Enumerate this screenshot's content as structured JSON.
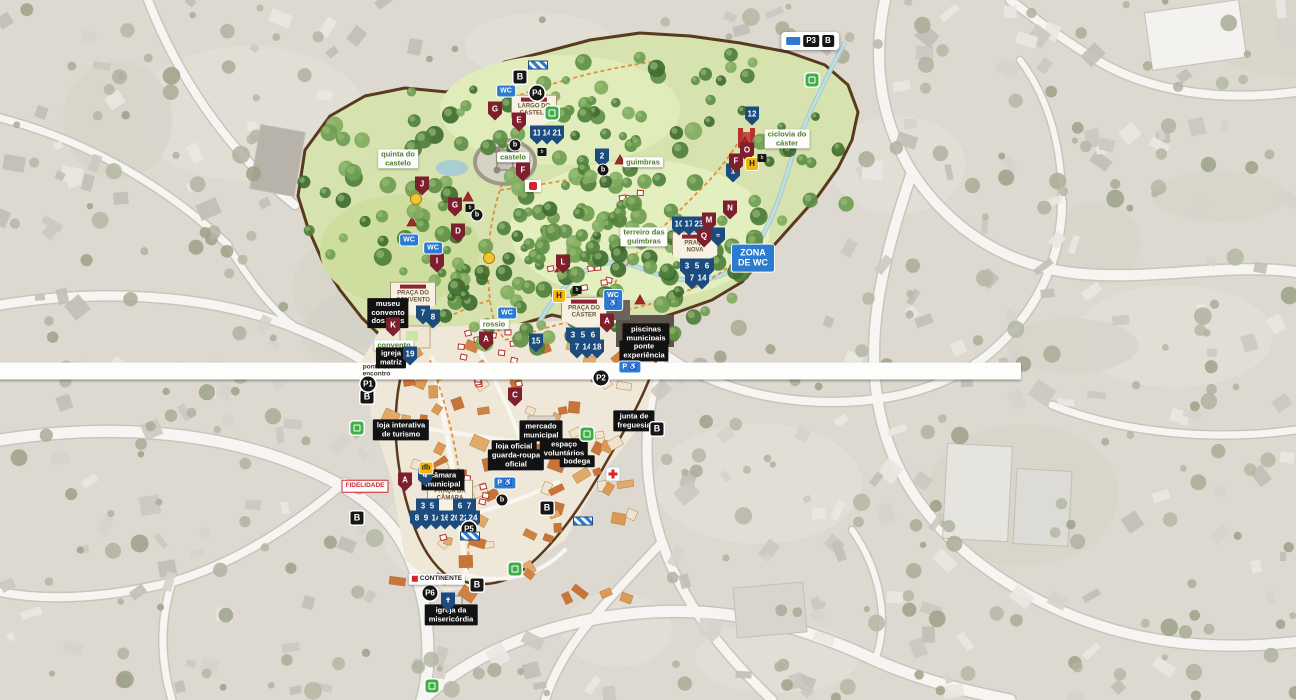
{
  "map": {
    "subject": "illustrated festival town map",
    "colors": {
      "attraction_shield_blue": "#1c4b7e",
      "area_shield_maroon": "#7d1f2d",
      "services_blue": "#2b7bd1",
      "festival_green": "#d7e3ae",
      "route_orange": "#e08a35",
      "fence_brown": "#5a3a1e",
      "entrance_green": "#3fae49"
    }
  },
  "markers": [
    {
      "name": "zone-crest-largo-do-castelo",
      "type": "crest",
      "x": 534,
      "y": 112,
      "lines": [
        "LARGO DO",
        "CASTELO"
      ]
    },
    {
      "name": "zone-crest-praca-do-convento",
      "type": "crest",
      "x": 413,
      "y": 299,
      "lines": [
        "PRAÇA DO",
        "CONVENTO"
      ]
    },
    {
      "name": "zone-crest-praca-nova",
      "type": "crest",
      "x": 695,
      "y": 249,
      "lines": [
        "PRAÇA",
        "NOVA"
      ]
    },
    {
      "name": "zone-crest-praca-do-caster",
      "type": "crest",
      "x": 584,
      "y": 314,
      "lines": [
        "PRAÇA DO",
        "CÁSTER"
      ]
    },
    {
      "name": "zone-crest-praca-da-camara",
      "type": "crest",
      "x": 450,
      "y": 497,
      "lines": [
        "PRAÇA DA",
        "CÂMARA"
      ]
    },
    {
      "name": "quinta-do-castelo-label",
      "type": "lblg",
      "x": 398,
      "y": 159,
      "lines": [
        "quinta do",
        "castelo"
      ]
    },
    {
      "name": "castelo-label",
      "type": "lblg",
      "x": 513,
      "y": 157,
      "text": "castelo"
    },
    {
      "name": "guimbras-label",
      "type": "lblg",
      "x": 643,
      "y": 162,
      "text": "guimbras"
    },
    {
      "name": "terreiro-das-guimbras-label",
      "type": "lblg",
      "x": 644,
      "y": 237,
      "lines": [
        "terreiro das",
        "guimbras"
      ]
    },
    {
      "name": "ciclovia-do-caster-label",
      "type": "lblg",
      "x": 787,
      "y": 139,
      "lines": [
        "ciclovia do",
        "cáster"
      ]
    },
    {
      "name": "rossio-label",
      "type": "lblg",
      "x": 494,
      "y": 324,
      "text": "rossio"
    },
    {
      "name": "convento-label",
      "type": "lblg",
      "x": 394,
      "y": 345,
      "text": "convento"
    },
    {
      "name": "ponto-de-encontro-label",
      "type": "lblw",
      "x": 373,
      "y": 371,
      "lines": [
        "ponto de",
        "encontro"
      ]
    },
    {
      "name": "museu-convento-dos-loios-label",
      "type": "lblb",
      "x": 388,
      "y": 313,
      "lines": [
        "museu",
        "convento",
        "dos lóios"
      ]
    },
    {
      "name": "igreja-matriz-label",
      "type": "lblb",
      "x": 391,
      "y": 358,
      "lines": [
        "igreja",
        "matriz"
      ]
    },
    {
      "name": "loja-interativa-de-turismo-label",
      "type": "lblb",
      "x": 401,
      "y": 430,
      "lines": [
        "loja interativa",
        "de turismo"
      ]
    },
    {
      "name": "camara-municipal-label",
      "type": "lblb",
      "x": 443,
      "y": 480,
      "lines": [
        "câmara",
        "municipal"
      ]
    },
    {
      "name": "mercado-municipal-label",
      "type": "lblb",
      "x": 541,
      "y": 431,
      "lines": [
        "mercado",
        "municipal"
      ]
    },
    {
      "name": "loja-oficial-label",
      "type": "lblb",
      "x": 514,
      "y": 446,
      "text": "loja oficial"
    },
    {
      "name": "guarda-roupa-oficial-label",
      "type": "lblb",
      "x": 516,
      "y": 460,
      "lines": [
        "guarda-roupa",
        "oficial"
      ]
    },
    {
      "name": "espaco-voluntarios-label",
      "type": "lblb",
      "x": 564,
      "y": 449,
      "lines": [
        "espaço",
        "voluntários"
      ]
    },
    {
      "name": "bodega-label",
      "type": "lblb",
      "x": 577,
      "y": 461,
      "text": "bodega"
    },
    {
      "name": "junta-de-freguesia-label",
      "type": "lblb",
      "x": 634,
      "y": 421,
      "lines": [
        "junta de",
        "freguesia"
      ]
    },
    {
      "name": "piscinas-municipais-label",
      "type": "lblb",
      "x": 646,
      "y": 334,
      "lines": [
        "piscinas",
        "municipais"
      ]
    },
    {
      "name": "ponte-experiencia-label",
      "type": "lblb",
      "x": 644,
      "y": 351,
      "lines": [
        "ponte",
        "experiência"
      ]
    },
    {
      "name": "igreja-da-misericordia-label",
      "type": "lblb",
      "x": 451,
      "y": 615,
      "lines": [
        "igreja da",
        "misericórdia"
      ]
    },
    {
      "name": "attraction-badge-11",
      "type": "sb",
      "x": 537,
      "y": 135,
      "text": "11"
    },
    {
      "name": "attraction-badge-14",
      "type": "sb",
      "x": 547,
      "y": 135,
      "text": "14"
    },
    {
      "name": "attraction-badge-21",
      "type": "sb",
      "x": 557,
      "y": 135,
      "text": "21"
    },
    {
      "name": "attraction-badge-2",
      "type": "sb",
      "x": 602,
      "y": 158,
      "text": "2"
    },
    {
      "name": "attraction-badge-12",
      "type": "sb",
      "x": 752,
      "y": 116,
      "text": "12"
    },
    {
      "name": "attraction-badge-1",
      "type": "sb",
      "x": 733,
      "y": 173,
      "text": "1"
    },
    {
      "name": "attraction-badge-10",
      "type": "sb",
      "x": 679,
      "y": 226,
      "text": "10"
    },
    {
      "name": "attraction-badge-17",
      "type": "sb",
      "x": 689,
      "y": 226,
      "text": "17"
    },
    {
      "name": "attraction-badge-23",
      "type": "sb",
      "x": 699,
      "y": 226,
      "text": "23"
    },
    {
      "name": "attraction-badge-3",
      "type": "sb",
      "x": 687,
      "y": 268,
      "text": "3"
    },
    {
      "name": "attraction-badge-5",
      "type": "sb",
      "x": 697,
      "y": 268,
      "text": "5"
    },
    {
      "name": "attraction-badge-6",
      "type": "sb",
      "x": 707,
      "y": 268,
      "text": "6"
    },
    {
      "name": "attraction-badge-7",
      "type": "sb",
      "x": 692,
      "y": 280,
      "text": "7"
    },
    {
      "name": "attraction-badge-14b",
      "type": "sb",
      "x": 702,
      "y": 280,
      "text": "14"
    },
    {
      "name": "attraction-badge-3b",
      "type": "sb",
      "x": 573,
      "y": 337,
      "text": "3"
    },
    {
      "name": "attraction-badge-5b",
      "type": "sb",
      "x": 583,
      "y": 337,
      "text": "5"
    },
    {
      "name": "attraction-badge-6b",
      "type": "sb",
      "x": 593,
      "y": 337,
      "text": "6"
    },
    {
      "name": "attraction-badge-7b",
      "type": "sb",
      "x": 577,
      "y": 349,
      "text": "7"
    },
    {
      "name": "attraction-badge-14c",
      "type": "sb",
      "x": 587,
      "y": 349,
      "text": "14"
    },
    {
      "name": "attraction-badge-18",
      "type": "sb",
      "x": 597,
      "y": 349,
      "text": "18"
    },
    {
      "name": "attraction-badge-15",
      "type": "sb",
      "x": 536,
      "y": 343,
      "text": "15"
    },
    {
      "name": "attraction-badge-7c",
      "type": "sb",
      "x": 423,
      "y": 315,
      "text": "7"
    },
    {
      "name": "attraction-badge-8",
      "type": "sb",
      "x": 433,
      "y": 319,
      "text": "8"
    },
    {
      "name": "attraction-badge-19",
      "type": "sb",
      "x": 410,
      "y": 356,
      "text": "19"
    },
    {
      "name": "attraction-badge-4",
      "type": "sb",
      "x": 425,
      "y": 477,
      "text": "4"
    },
    {
      "name": "attraction-badge-3c",
      "type": "sb",
      "x": 423,
      "y": 508,
      "text": "3"
    },
    {
      "name": "attraction-badge-5c",
      "type": "sb",
      "x": 432,
      "y": 508,
      "text": "5"
    },
    {
      "name": "attraction-badge-6c",
      "type": "sb",
      "x": 460,
      "y": 508,
      "text": "6"
    },
    {
      "name": "attraction-badge-7d",
      "type": "sb",
      "x": 469,
      "y": 508,
      "text": "7"
    },
    {
      "name": "attraction-badge-8b",
      "type": "sb",
      "x": 417,
      "y": 520,
      "text": "8"
    },
    {
      "name": "attraction-badge-9",
      "type": "sb",
      "x": 426,
      "y": 520,
      "text": "9"
    },
    {
      "name": "attraction-badge-14d",
      "type": "sb",
      "x": 436,
      "y": 520,
      "text": "14"
    },
    {
      "name": "attraction-badge-16",
      "type": "sb",
      "x": 445,
      "y": 520,
      "text": "16"
    },
    {
      "name": "attraction-badge-20",
      "type": "sb",
      "x": 455,
      "y": 520,
      "text": "20"
    },
    {
      "name": "attraction-badge-22",
      "type": "sb",
      "x": 464,
      "y": 520,
      "text": "22"
    },
    {
      "name": "attraction-badge-24",
      "type": "sb",
      "x": 473,
      "y": 520,
      "text": "24"
    },
    {
      "name": "church-badge",
      "type": "sbi",
      "x": 448,
      "y": 602,
      "text": "✝"
    },
    {
      "name": "fountain-badge",
      "type": "sbi",
      "x": 718,
      "y": 237,
      "text": "≈"
    },
    {
      "name": "area-badge-e",
      "type": "sm",
      "x": 519,
      "y": 122,
      "text": "E"
    },
    {
      "name": "area-badge-f",
      "type": "sm",
      "x": 523,
      "y": 172,
      "text": "F"
    },
    {
      "name": "area-badge-g",
      "type": "sm",
      "x": 495,
      "y": 111,
      "text": "G"
    },
    {
      "name": "area-badge-g2",
      "type": "sm",
      "x": 455,
      "y": 207,
      "text": "G"
    },
    {
      "name": "area-badge-j",
      "type": "sm",
      "x": 422,
      "y": 186,
      "text": "J"
    },
    {
      "name": "area-badge-d",
      "type": "sm",
      "x": 458,
      "y": 233,
      "text": "D"
    },
    {
      "name": "area-badge-i",
      "type": "sm",
      "x": 437,
      "y": 263,
      "text": "I"
    },
    {
      "name": "area-badge-l",
      "type": "sm",
      "x": 563,
      "y": 264,
      "text": "L"
    },
    {
      "name": "area-badge-a",
      "type": "sm",
      "x": 486,
      "y": 341,
      "text": "A"
    },
    {
      "name": "area-badge-a2",
      "type": "sm",
      "x": 607,
      "y": 323,
      "text": "A"
    },
    {
      "name": "area-badge-a3",
      "type": "sm",
      "x": 405,
      "y": 482,
      "text": "A"
    },
    {
      "name": "area-badge-k",
      "type": "sm",
      "x": 393,
      "y": 327,
      "text": "K"
    },
    {
      "name": "area-badge-m",
      "type": "sm",
      "x": 709,
      "y": 222,
      "text": "M"
    },
    {
      "name": "area-badge-n",
      "type": "sm",
      "x": 730,
      "y": 210,
      "text": "N"
    },
    {
      "name": "area-badge-q",
      "type": "sm",
      "x": 704,
      "y": 238,
      "text": "Q"
    },
    {
      "name": "area-badge-o",
      "type": "sm",
      "x": 747,
      "y": 152,
      "text": "O"
    },
    {
      "name": "area-badge-f2",
      "type": "sm",
      "x": 736,
      "y": 163,
      "text": "F"
    },
    {
      "name": "area-badge-c",
      "type": "sm",
      "x": 515,
      "y": 397,
      "text": "C"
    },
    {
      "name": "wc-badge-1",
      "type": "wc",
      "x": 506,
      "y": 91,
      "text": "WC"
    },
    {
      "name": "wc-badge-2",
      "type": "wc",
      "x": 409,
      "y": 240,
      "text": "WC"
    },
    {
      "name": "wc-badge-3",
      "type": "wc",
      "x": 433,
      "y": 248,
      "text": "WC"
    },
    {
      "name": "wc-badge-4",
      "type": "wc",
      "x": 507,
      "y": 313,
      "text": "WC"
    },
    {
      "name": "wc-accessible-badge",
      "type": "wca",
      "x": 613,
      "y": 300,
      "lines": [
        "WC",
        "♿"
      ]
    },
    {
      "name": "parking-accessible-badge",
      "type": "pacc",
      "x": 630,
      "y": 367,
      "text": "P ♿"
    },
    {
      "name": "parking-accessible-badge-2",
      "type": "pacc",
      "x": 505,
      "y": 483,
      "text": "P ♿"
    },
    {
      "name": "zona-de-wc-badge",
      "type": "zwc",
      "x": 753,
      "y": 258,
      "lines": [
        "ZONA",
        "DE WC"
      ]
    },
    {
      "name": "bus-stop-badge-1",
      "type": "bb",
      "x": 520,
      "y": 77,
      "text": "B"
    },
    {
      "name": "bus-stop-badge-2",
      "type": "bb",
      "x": 367,
      "y": 397,
      "text": "B"
    },
    {
      "name": "bus-stop-badge-3",
      "type": "bb",
      "x": 357,
      "y": 518,
      "text": "B"
    },
    {
      "name": "bus-stop-badge-4",
      "type": "bb",
      "x": 547,
      "y": 508,
      "text": "B"
    },
    {
      "name": "bus-stop-badge-5",
      "type": "bb",
      "x": 657,
      "y": 429,
      "text": "B"
    },
    {
      "name": "bus-stop-badge-6",
      "type": "bb",
      "x": 477,
      "y": 585,
      "text": "B"
    },
    {
      "name": "parking-badge-p1",
      "type": "pc",
      "x": 368,
      "y": 384,
      "text": "P1"
    },
    {
      "name": "parking-badge-p2",
      "type": "pc",
      "x": 601,
      "y": 378,
      "text": "P2"
    },
    {
      "name": "parking-badge-p4",
      "type": "pc",
      "x": 537,
      "y": 93,
      "text": "P4"
    },
    {
      "name": "parking-badge-p5",
      "type": "pc",
      "x": 469,
      "y": 529,
      "text": "P5"
    },
    {
      "name": "parking-badge-p6",
      "type": "pc",
      "x": 430,
      "y": 593,
      "text": "P6"
    },
    {
      "name": "park-info-pill",
      "type": "parkpill",
      "x": 810,
      "y": 41,
      "badges": [
        "P3",
        "B"
      ]
    },
    {
      "name": "entrance-icon-1",
      "type": "gi",
      "x": 812,
      "y": 63
    },
    {
      "name": "entrance-icon-2",
      "type": "gi",
      "x": 552,
      "y": 83
    },
    {
      "name": "entrance-icon-3",
      "type": "gi",
      "x": 357,
      "y": 385
    },
    {
      "name": "entrance-icon-4",
      "type": "gi",
      "x": 587,
      "y": 378
    },
    {
      "name": "entrance-icon-5",
      "type": "gi",
      "x": 515,
      "y": 500
    },
    {
      "name": "entrance-icon-6",
      "type": "gi",
      "x": 432,
      "y": 604
    },
    {
      "name": "helipad-badge-1",
      "type": "yh",
      "x": 752,
      "y": 164,
      "text": "H"
    },
    {
      "name": "helipad-badge-2",
      "type": "yh",
      "x": 559,
      "y": 296,
      "text": "H"
    },
    {
      "name": "yellow-point-badge-1",
      "type": "yd",
      "x": 416,
      "y": 199
    },
    {
      "name": "yellow-point-badge-2",
      "type": "yd",
      "x": 489,
      "y": 258
    },
    {
      "name": "yellow-db-badge",
      "type": "ydb",
      "x": 426,
      "y": 468,
      "text": "db"
    },
    {
      "name": "mini-badge-1",
      "type": "mb",
      "x": 542,
      "y": 152,
      "text": "b"
    },
    {
      "name": "mini-badge-2",
      "type": "mb",
      "x": 470,
      "y": 208,
      "text": "b"
    },
    {
      "name": "mini-badge-3",
      "type": "mb",
      "x": 577,
      "y": 290,
      "text": "b"
    },
    {
      "name": "mini-badge-4",
      "type": "mb",
      "x": 762,
      "y": 158,
      "text": "b"
    },
    {
      "name": "water-point-badge-1",
      "type": "bd",
      "x": 515,
      "y": 145,
      "text": "b"
    },
    {
      "name": "water-point-badge-2",
      "type": "bd",
      "x": 477,
      "y": 215,
      "text": "b"
    },
    {
      "name": "water-point-badge-3",
      "type": "bd",
      "x": 603,
      "y": 170,
      "text": "b"
    },
    {
      "name": "water-point-badge-4",
      "type": "bd",
      "x": 502,
      "y": 500,
      "text": "b"
    },
    {
      "name": "first-aid-icon",
      "type": "med",
      "x": 613,
      "y": 379
    },
    {
      "name": "gate-marker-1",
      "type": "gs",
      "x": 538,
      "y": 65
    },
    {
      "name": "gate-marker-2",
      "type": "gs",
      "x": 470,
      "y": 536
    },
    {
      "name": "gate-marker-3",
      "type": "gs",
      "x": 583,
      "y": 521
    },
    {
      "name": "sponsor-fidelidade-badge",
      "type": "sp-fid",
      "x": 365,
      "y": 486,
      "text": "FIDELIDADE"
    },
    {
      "name": "sponsor-continente-badge",
      "type": "sp-cont",
      "x": 437,
      "y": 579,
      "text": "CONTINENTE"
    },
    {
      "name": "sponsor-logo-badge",
      "type": "sp-red",
      "x": 533,
      "y": 78
    }
  ]
}
